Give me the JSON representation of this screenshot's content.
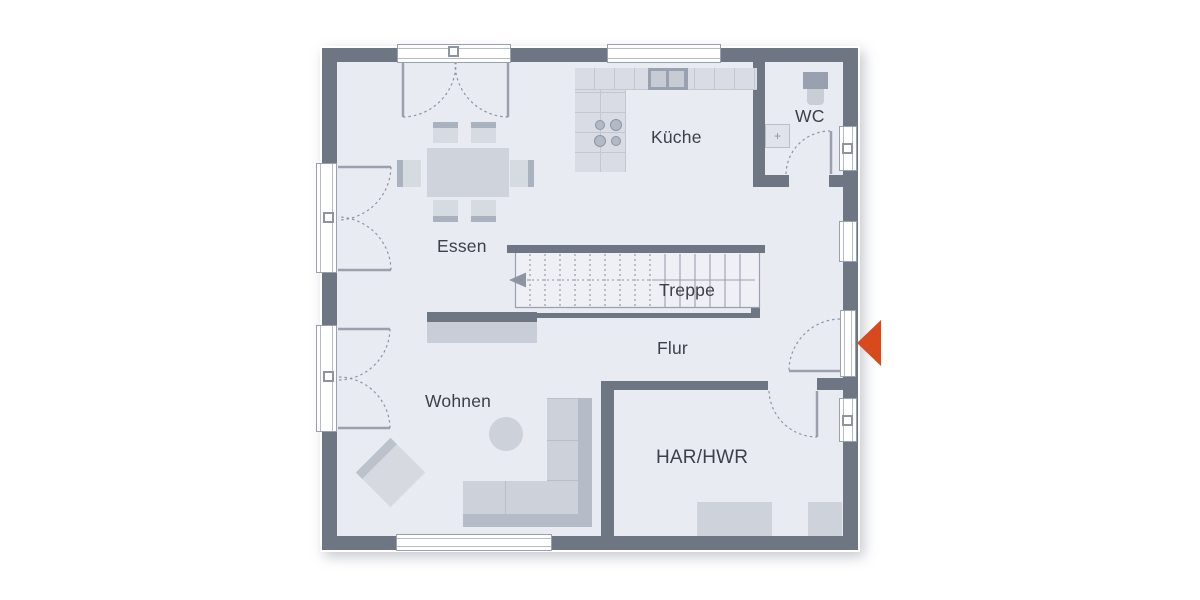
{
  "plan": {
    "rooms": [
      {
        "id": "essen",
        "label": "Essen"
      },
      {
        "id": "kueche",
        "label": "Küche"
      },
      {
        "id": "wc",
        "label": "WC"
      },
      {
        "id": "treppe",
        "label": "Treppe"
      },
      {
        "id": "flur",
        "label": "Flur"
      },
      {
        "id": "wohnen",
        "label": "Wohnen"
      },
      {
        "id": "har-hwr",
        "label": "HAR/HWR"
      }
    ],
    "icons": {
      "entrance_arrow": "left-pointing-triangle",
      "stairs_direction_arrow": "left-pointing-triangle"
    },
    "colors": {
      "wall": "#6e7684",
      "floor": "#e9ebf2",
      "furniture": "#d0d4dd",
      "furniture_shade": "#aeb5c2",
      "counter": "#d9dce4",
      "fixture_dark": "#99a1b0",
      "outline_gray": "#9aa1ad",
      "entrance_arrow": "#d8491d",
      "label_text": "#3c4149"
    }
  }
}
